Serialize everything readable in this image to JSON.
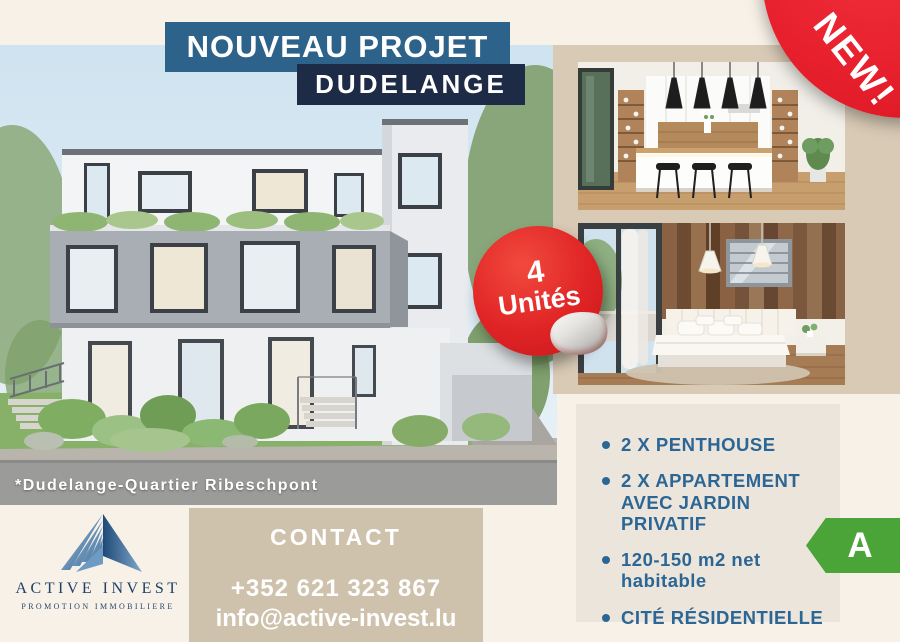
{
  "header": {
    "title_line1": "NOUVEAU PROJET",
    "title_line2": "DUDELANGE"
  },
  "new_ribbon": {
    "label": "NEW!"
  },
  "units_sticker": {
    "line1": "4",
    "line2": "Unités"
  },
  "building": {
    "caption": "*Dudelange-Quartier Ribeschpont"
  },
  "photos": {
    "kitchen_alt": "kitchen interior render",
    "bedroom_alt": "bedroom interior render"
  },
  "features": {
    "items": [
      "2 X PENTHOUSE",
      "2 X APPARTEMENT AVEC JARDIN PRIVATIF",
      "120-150 m2 net habitable",
      "CITÉ RÉSIDENTIELLE"
    ]
  },
  "energy_badge": {
    "label": "A"
  },
  "contact": {
    "heading": "CONTACT",
    "phone": "+352 621 323 867",
    "email": "info@active-invest.lu"
  },
  "logo": {
    "name": "ACTIVE INVEST",
    "tagline": "PROMOTION IMMOBILIERE"
  },
  "colors": {
    "accent_red": "#e8202e",
    "navy": "#1d2b47",
    "steel_blue": "#2d628b",
    "feature_text": "#2c6695",
    "energy_green": "#4aa437",
    "beige_panel": "#d8cab5",
    "contact_panel": "#cfc2ad",
    "cream_background": "#f7f1e7"
  }
}
